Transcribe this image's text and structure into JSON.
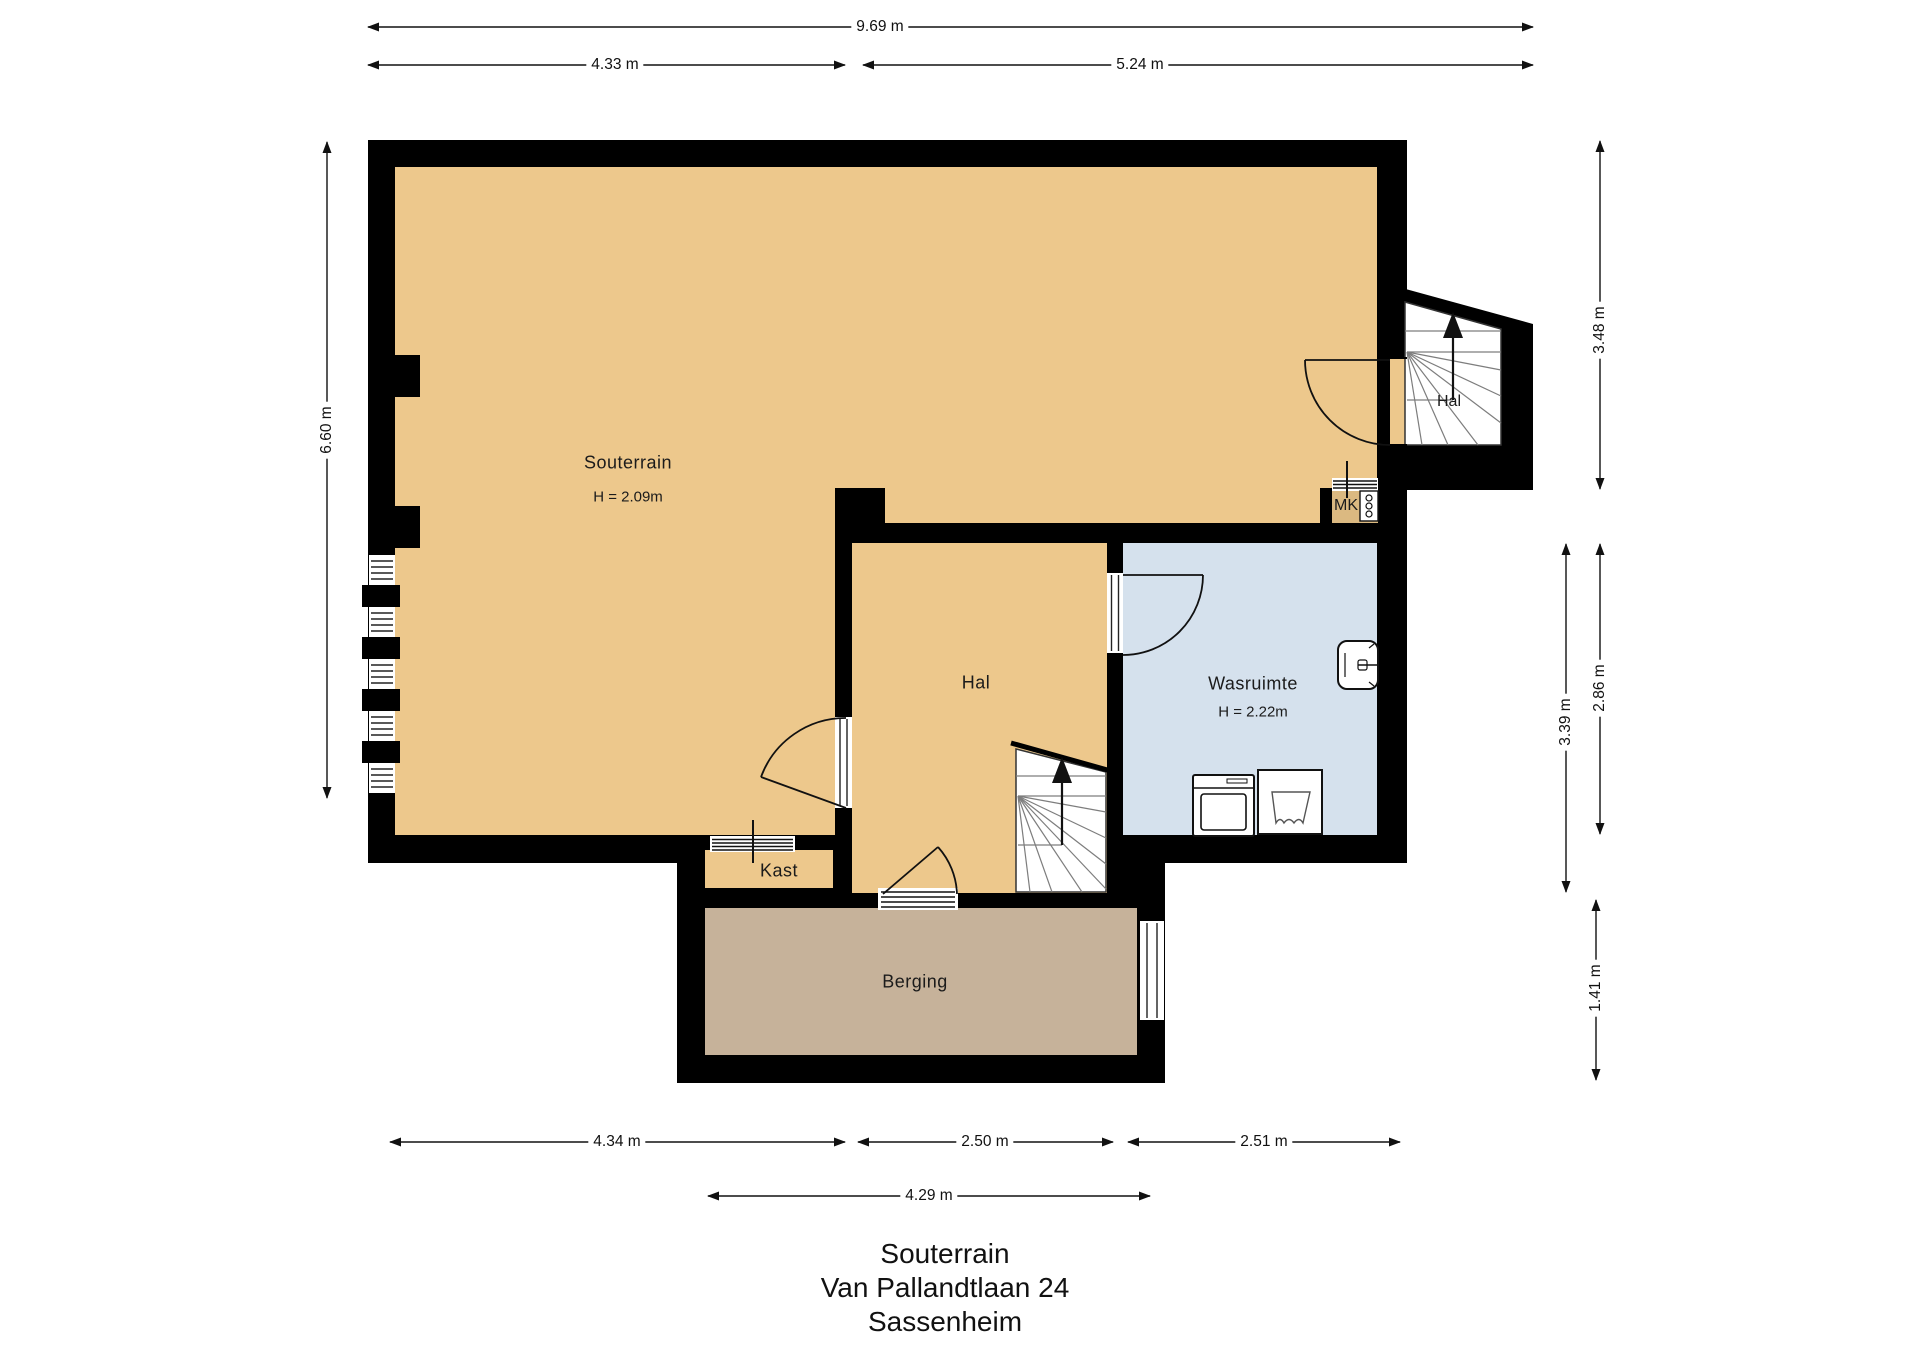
{
  "plan": {
    "rooms": {
      "souterrain": {
        "label": "Souterrain",
        "height": "H = 2.09m"
      },
      "hal_upper": {
        "label": "Hal"
      },
      "hal_main": {
        "label": "Hal"
      },
      "wasruimte": {
        "label": "Wasruimte",
        "height": "H = 2.22m"
      },
      "mk": {
        "label": "MK"
      },
      "kast": {
        "label": "Kast"
      },
      "berging": {
        "label": "Berging"
      }
    },
    "dimensions": {
      "top_total": "9.69 m",
      "top_left": "4.33 m",
      "top_right": "5.24 m",
      "left_height": "6.60 m",
      "right_upper": "3.48 m",
      "right_middle": "2.86 m",
      "right_outer": "3.39 m",
      "right_lower": "1.41 m",
      "bottom_left": "4.34 m",
      "bottom_middle": "2.50 m",
      "bottom_right": "2.51 m",
      "bottom_berging": "4.29 m"
    },
    "colors": {
      "floor_main": "#edc88c",
      "floor_wet": "#d5e1ed",
      "floor_storage": "#c6b29a",
      "floor_mk": "#dbb981",
      "wall": "#000000"
    }
  },
  "title": {
    "line1": "Souterrain",
    "line2": "Van Pallandtlaan 24",
    "line3": "Sassenheim"
  }
}
